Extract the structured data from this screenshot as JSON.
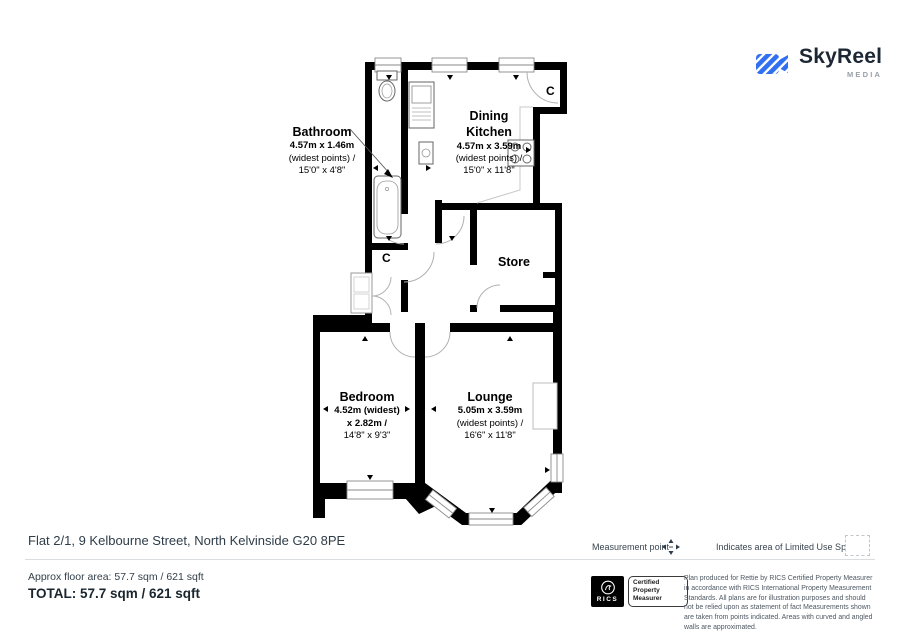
{
  "logo": {
    "name": "SkyReel",
    "tagline": "MEDIA"
  },
  "plan": {
    "rooms": {
      "bathroom": {
        "name": "Bathroom",
        "dim1": "4.57m x 1.46m",
        "dim2": "(widest points) /",
        "dim3": "15'0\" x 4'8\""
      },
      "dining_kitchen": {
        "name1": "Dining",
        "name2": "Kitchen",
        "dim1": "4.57m x 3.59m",
        "dim2": "(widest points) /",
        "dim3": "15'0\" x 11'8\""
      },
      "store": {
        "name": "Store"
      },
      "bedroom": {
        "name": "Bedroom",
        "dim1": "4.52m (widest)",
        "dim2": "x 2.82m /",
        "dim3": "14'8\" x 9'3\""
      },
      "lounge": {
        "name": "Lounge",
        "dim1": "5.05m x 3.59m",
        "dim2": "(widest points) /",
        "dim3": "16'6\" x 11'8\""
      },
      "cupboard_kitchen": {
        "label": "C"
      },
      "cupboard_hall": {
        "label": "C"
      }
    }
  },
  "address": "Flat 2/1, 9 Kelbourne Street, North Kelvinside G20 8PE",
  "legend": {
    "measurement_point": "Measurement point",
    "limited_use": "Indicates area of Limited Use Space"
  },
  "footer": {
    "approx_area": "Approx floor area: 57.7 sqm / 621 sqft",
    "total": "TOTAL: 57.7 sqm / 621 sqft",
    "rics_brand": "RICS",
    "rics_certification": "Certified Property Measurer",
    "disclaimer": "Plan produced for Rettie by RICS Certified Property Measurer in accordance with RICS International Property Measurement Standards. All plans are for illustration purposes and should not be relied upon as statement of fact Measurements shown are taken from points indicated. Areas with curved and angled walls are approximated."
  },
  "colors": {
    "accent_blue": "#2F6FF0",
    "text_dark": "#2E3D49",
    "text_gray": "#5A6570",
    "plan_black": "#000000"
  }
}
